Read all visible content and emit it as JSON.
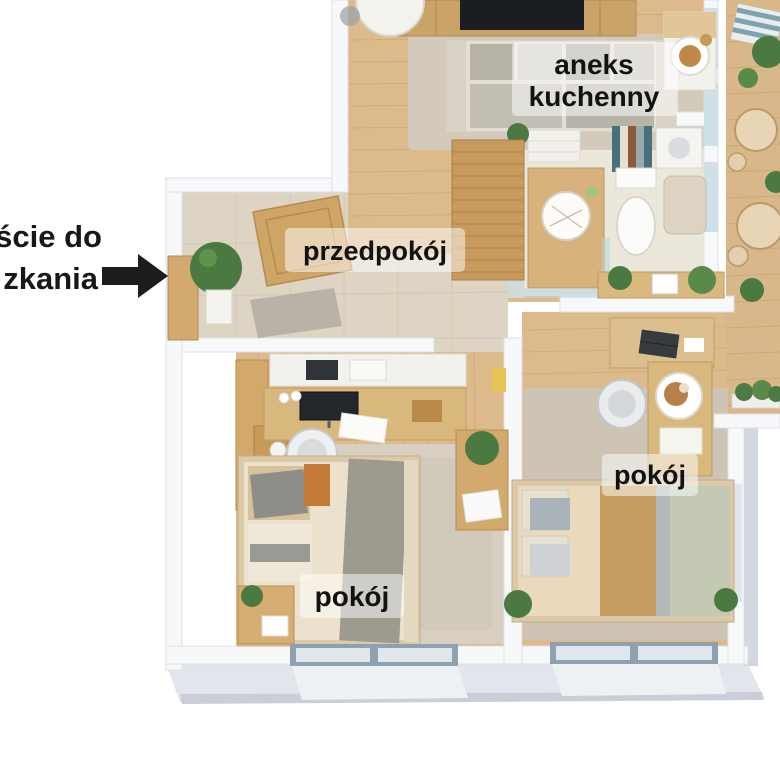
{
  "scene": {
    "kind": "3d-apartment-floor-plan",
    "background": "#ffffff"
  },
  "annotation": {
    "line1": "ście do",
    "line2": "zkania",
    "arrow_icon": "right-arrow",
    "text_color": "#171717"
  },
  "labels": {
    "kitchen_line1": "aneks",
    "kitchen_line2": "kuchenny",
    "hallway": "przedpokój",
    "room_bottom": "pokój",
    "room_right": "pokój"
  },
  "palette": {
    "wall_top": "#f7f8fa",
    "wall_edge": "#dcdfe5",
    "wall_side": "#ccd2da",
    "wood_floor": "#ddba8c",
    "wood_line": "#c39a66",
    "tile_floor": "#ded4c3",
    "bath_floor": "#ece7db",
    "carpet": "#cdc4b6",
    "rug_beige": "#d8cfc2",
    "rug_gray": "#b5afa4",
    "label_bg": "rgba(255,255,255,0.55)",
    "label_text": "#121212",
    "plant_green": "#4a7a42",
    "glass": "#cfe0e8",
    "window_frame": "#8fa0b0",
    "sofa_base": "#e4ded2",
    "sofa_cushion": "#b6b2a8",
    "tv_black": "#1a1d21",
    "desk_wood": "#d9b87e",
    "bed_cream": "#ead9bd",
    "bed_tan": "#c79e62",
    "bed_sage": "#c3c9b2",
    "bed_gray": "#9f9a90",
    "accent_yellow": "#e7c353"
  }
}
